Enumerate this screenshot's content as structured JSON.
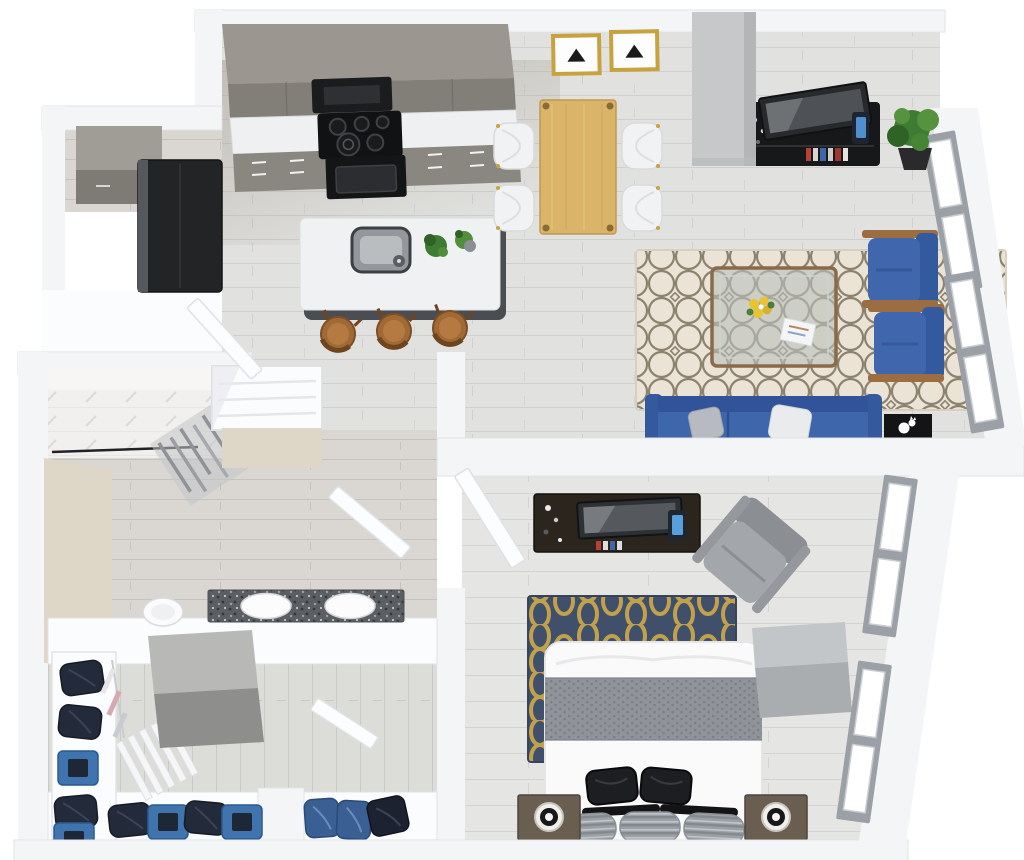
{
  "scene": {
    "kind": "3d_floor_plan_rendering",
    "view": "top_down_dollhouse_perspective",
    "description": "Photoreal 3D overhead rendering of a one-bedroom apartment floor plan on a white background. Open kitchen/dining/living area across the top, bathroom and walk-in closet at lower left, bedroom at lower right.",
    "rooms": [
      {
        "name": "Kitchen",
        "items": [
          "taupe upper cabinets",
          "white quartz counter",
          "black range hood",
          "black cooktop with burners",
          "black oven",
          "taupe base cabinets with drawer pulls",
          "black refrigerator",
          "taupe laundry/pantry cabinet in alcove",
          "white quartz island with undermount sink and faucet",
          "two small potted plants",
          "three wood barrel stools"
        ]
      },
      {
        "name": "Dining Area",
        "items": [
          "light wood dining table",
          "four white wing chairs with gold legs",
          "two gold-framed black-triangle wall prints"
        ]
      },
      {
        "name": "Living Room",
        "items": [
          "gray concrete column",
          "black media console with decor and books",
          "flat-screen TV leaning on console",
          "corner potted plant",
          "two royal-blue accent chairs with wood arms",
          "bronze-framed glass coffee table with yellow flowers and magazine",
          "cream quatrefoil-pattern area rug",
          "blue sofa with white and gray throw pillows",
          "black side table with white cat",
          "two tall windows on right wall"
        ]
      },
      {
        "name": "Bathroom",
        "items": [
          "walk-in tiled shower with black curtain rod and gray curtain",
          "beige accent wall",
          "white toilet",
          "double vanity with dark speckled granite counter and two white sinks",
          "linen closet with shelves",
          "white swing door"
        ]
      },
      {
        "name": "Walk-in Closet",
        "items": [
          "white wall shelving with folded navy clothes",
          "blue storage boxes",
          "hanging clothes on rod",
          "white slatted shoe shelves",
          "two-tone gray storage island",
          "navy and denim shoes on low shelf",
          "white swing door"
        ]
      },
      {
        "name": "Bedroom",
        "items": [
          "dark walnut dresser with decor and colored books",
          "flat-screen TV on dresser",
          "blue smart speaker",
          "gray upholstered armchair",
          "navy and gold trellis rug",
          "bed with white duvet and gray knit throw",
          "two black accent pillows",
          "black trim pillows",
          "three gray striped pillows",
          "two dark wood nightstands with round lamps",
          "gray wall-mounted desk",
          "two tall windows on right wall",
          "white swing door"
        ]
      }
    ]
  },
  "palette": {
    "bg": "#ffffff",
    "wall": "#f4f5f6",
    "wall_bright": "#fbfcfd",
    "wall_shadow": "#dfe2e5",
    "door_white": "#fcfdfe",
    "floor_light": "#e1e2e0",
    "floor_line": "#cfd0cd",
    "floor_bath": "#dad7d2",
    "floor_kitchen_tint": "#a89f93",
    "cabinet_top": "#9b968f",
    "cabinet_front": "#827e78",
    "counter_white": "#eef0f1",
    "appliance_black": "#17181a",
    "island_base": "#4a4d52",
    "island_top": "#f0f1f2",
    "sink_gray": "#94989c",
    "stool_wood": "#a06a34",
    "table_wood": "#d9b469",
    "chair_white": "#f1f2f3",
    "gold_frame": "#c9a240",
    "concrete": "#c6c8ca",
    "plant_green": "#3f7c33",
    "rug_cream": "#ebe4d6",
    "rug_pattern_taupe": "#8d8170",
    "bronze": "#8a6a48",
    "glass_green": "#b9c2bd",
    "flower_yellow": "#e8c530",
    "chair_blue": "#3a62a6",
    "sofa_blue": "#3e66ab",
    "pillow_white": "#e9ebed",
    "pillow_gray": "#b7bbc1",
    "shower_tile": "#f1f0ee",
    "tan_accent": "#ded6c6",
    "curtain_gray": "#8f9296",
    "granite_dark": "#5b5f63",
    "fixture_white": "#fbfbfc",
    "navy_cloth": "#232a3a",
    "denim_blue": "#3a5f93",
    "box_blue": "#3f74ae",
    "closet_island_light": "#b8b8b6",
    "closet_island_dark": "#8e8e8c",
    "rug_navy": "#41506a",
    "rug_gold": "#c1a14d",
    "bed_white": "#fafafb",
    "throw_gray": "#90949a",
    "pillow_black": "#1d1e21",
    "nightstand_wood": "#6a5e50",
    "armchair_gray": "#a3a6aa",
    "desk_gray": "#b5b8bb",
    "window_frame": "#9ba0a6",
    "window_pane": "#ffffff"
  }
}
